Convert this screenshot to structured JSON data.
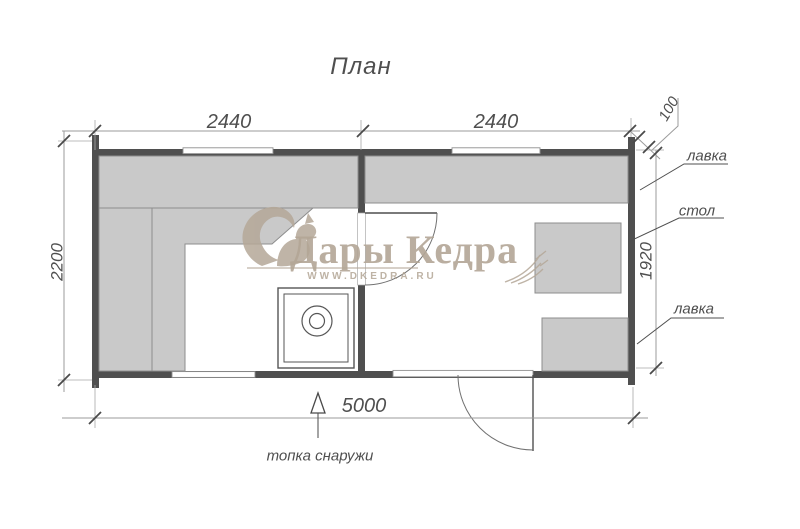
{
  "title": "План",
  "dimensions": {
    "top_span_left": "2440",
    "top_span_right": "2440",
    "wall_offset": "100",
    "left_height": "2200",
    "right_inner_height": "1920",
    "bottom_total": "5000"
  },
  "labels": {
    "bench_upper": "лавка",
    "table": "стол",
    "bench_lower": "лавка",
    "firebox_note": "топка снаружи"
  },
  "watermark": {
    "brand": "Дары Кедра",
    "url": "WWW.DKEDRA.RU"
  },
  "colors": {
    "wall": "#4f4f4f",
    "bench_fill": "#c9c9c9",
    "bench_stroke": "#8d8d8d",
    "dim_line": "#9b9b9b",
    "draft_text": "#4f4f4f",
    "watermark": "#b3a696",
    "background": "#ffffff"
  }
}
